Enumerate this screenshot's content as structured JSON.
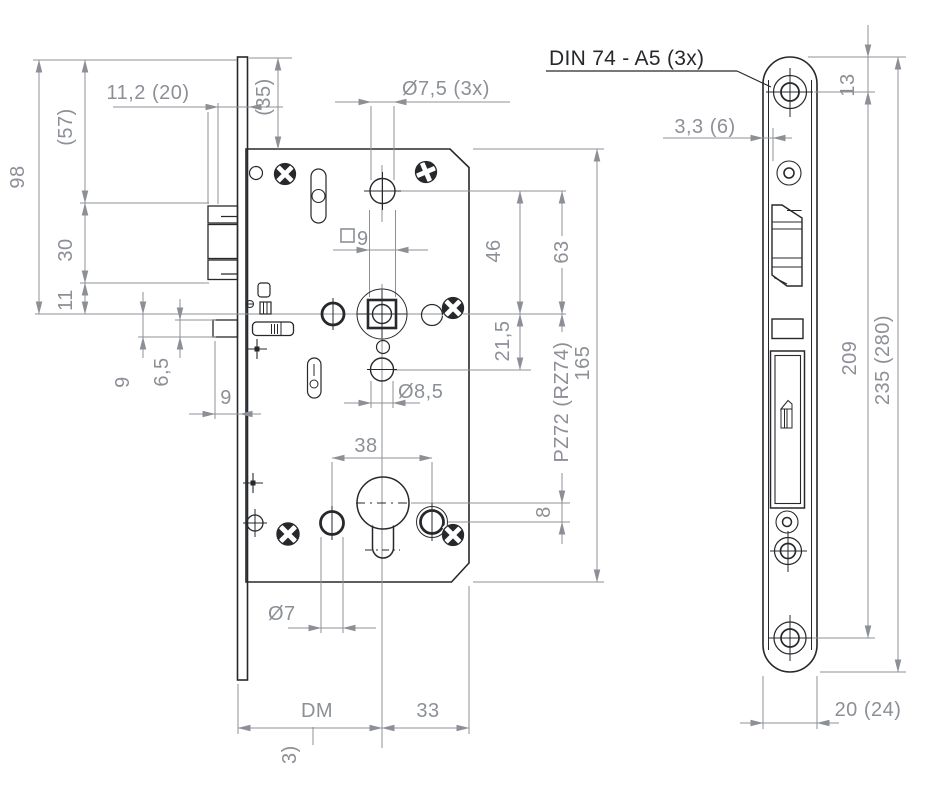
{
  "document": {
    "kind": "mortise-lock technical drawing"
  },
  "colors": {
    "line_dark": "#26282b",
    "dimension_gray": "#8c9096",
    "background": "#ffffff"
  },
  "front_view": {
    "dim_11_2": "11,2 (20)",
    "dim_57": "(57)",
    "dim_98": "98",
    "dim_35": "(35)",
    "dim_30": "30",
    "dim_11": "11",
    "dim_dia_7_5": "Ø7,5 (3x)",
    "dim_square_9": "9",
    "dim_46": "46",
    "dim_63": "63",
    "dim_21_5": "21,5",
    "dim_pz": "PZ72 (RZ74)",
    "dim_165": "165",
    "dim_dia_8_5": "Ø8,5",
    "dim_9_left": "9",
    "dim_6_5": "6,5",
    "dim_9_throw": "9",
    "dim_38": "38",
    "dim_8": "8",
    "dim_dia_7": "Ø7",
    "dim_dm": "DM",
    "dim_33": "33",
    "dim_clipped": "3)"
  },
  "faceplate_view": {
    "callout_din": "DIN 74 - A5 (3x)",
    "dim_13": "13",
    "dim_3_3": "3,3 (6)",
    "dim_209": "209",
    "dim_235": "235 (280)",
    "dim_20": "20 (24)"
  }
}
